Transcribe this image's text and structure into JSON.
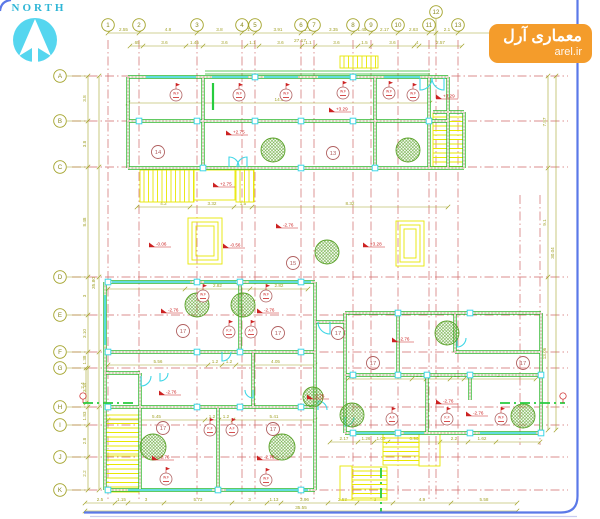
{
  "compass": {
    "label": "NORTH",
    "circle_color": "#55d6ef",
    "arrow_color": "#ffffff"
  },
  "watermark": {
    "line1": "معماری آرل",
    "line2": "arel.ir",
    "bg": "#f49c2b"
  },
  "colors": {
    "wall": "#2eb82e",
    "wall_core": "#ffffff",
    "wall_hatch": "#dd8888",
    "centerline": "#d06868",
    "dim": "#a3a32a",
    "window": "#3fd6e6",
    "stair": "#e8e800",
    "room": "#b06060",
    "balloon": "#b06060",
    "level": "#cc2222",
    "hatch_circle": "#5ba32a",
    "section": "#27cc3e",
    "frame": "#5b79e8",
    "frame_light": "#c9cdf0"
  },
  "grid": {
    "bubble_row_y": 25,
    "bubble_col_x": 60,
    "columns": [
      {
        "l": "1",
        "x": 108
      },
      {
        "l": "2",
        "x": 139
      },
      {
        "l": "3",
        "x": 197
      },
      {
        "l": "4",
        "x": 242
      },
      {
        "l": "5",
        "x": 255
      },
      {
        "l": "6",
        "x": 301
      },
      {
        "l": "7",
        "x": 314
      },
      {
        "l": "8",
        "x": 353
      },
      {
        "l": "9",
        "x": 371
      },
      {
        "l": "10",
        "x": 398
      },
      {
        "l": "11",
        "x": 429
      },
      {
        "l": "12",
        "x": 436,
        "y": 12
      },
      {
        "l": "13",
        "x": 458
      }
    ],
    "rows": [
      {
        "l": "A",
        "y": 76
      },
      {
        "l": "B",
        "y": 121
      },
      {
        "l": "C",
        "y": 167
      },
      {
        "l": "D",
        "y": 277
      },
      {
        "l": "E",
        "y": 315
      },
      {
        "l": "F",
        "y": 352
      },
      {
        "l": "G",
        "y": 368
      },
      {
        "l": "H",
        "y": 407
      },
      {
        "l": "I",
        "y": 425
      },
      {
        "l": "J",
        "y": 457
      },
      {
        "l": "K",
        "y": 490
      }
    ],
    "extra_centerlines_x": [
      {
        "x": 520,
        "y1": 195,
        "y2": 445
      },
      {
        "x": 540,
        "y1": 195,
        "y2": 445
      }
    ]
  },
  "dimlines": [
    {
      "o": "h",
      "pos": 33,
      "ticks": [
        108,
        139,
        197,
        242,
        255,
        301,
        314,
        353,
        371,
        398,
        429,
        436,
        458,
        540
      ],
      "labels": [
        "2.55",
        "4.8",
        "3.8",
        "1",
        "3.91",
        "1.1",
        "3.35",
        "1.45",
        "2.17",
        "2.63",
        ".5",
        "2.1",
        ""
      ]
    },
    {
      "o": "h",
      "pos": 46,
      "ticks": [
        130,
        143,
        186,
        203,
        246,
        259,
        302,
        315,
        358,
        371,
        414,
        419,
        462
      ],
      "labels": [
        ".65",
        "3.6",
        "1.45",
        "3.6",
        "1.1",
        "3.6",
        "1.1",
        "3.6",
        "1.5",
        "3.6",
        ".4",
        "2.57"
      ]
    },
    {
      "o": "v",
      "pos": 88,
      "ticks": [
        76,
        121,
        167,
        277,
        315,
        352,
        368,
        407,
        425,
        457,
        490
      ],
      "labels": [
        "3.8",
        "3.8",
        "8.48",
        "3",
        "3.10",
        "1.38",
        "3.18",
        "1.83",
        "2.8",
        "2.2"
      ]
    },
    {
      "o": "v",
      "pos": 99,
      "ticks": [
        76,
        167,
        277,
        352,
        407,
        490
      ],
      "labels": [
        "",
        "",
        "",
        "",
        ""
      ]
    },
    {
      "o": "v",
      "pos": 548,
      "ticks": [
        76,
        168,
        277,
        430
      ],
      "labels": [
        "7.87",
        "9.1",
        "13.06"
      ]
    },
    {
      "o": "v",
      "pos": 556,
      "ticks": [
        76,
        430
      ],
      "labels": [
        "30.04"
      ]
    },
    {
      "o": "h",
      "pos": 503,
      "ticks": [
        85,
        115,
        128,
        164,
        232,
        267,
        281,
        328,
        357,
        393,
        451,
        517
      ],
      "labels": [
        "2.5",
        "1.15",
        "3",
        "5.73",
        "3",
        "1.13",
        "3.96",
        "2.53",
        "3",
        "4.9",
        "5.58"
      ]
    },
    {
      "o": "h",
      "pos": 511,
      "ticks": [
        85,
        517
      ],
      "labels": [
        "35.55"
      ]
    },
    {
      "o": "h",
      "pos": 103,
      "ticks": [
        128,
        430
      ],
      "labels": [
        "14.5"
      ]
    },
    {
      "o": "h",
      "pos": 207,
      "ticks": [
        137,
        190,
        234,
        252,
        448
      ],
      "labels": [
        "4.2",
        "3.32",
        "1.5",
        "8.32"
      ]
    },
    {
      "o": "h",
      "pos": 289,
      "ticks": [
        108,
        185,
        250,
        308
      ],
      "labels": [
        "",
        "2.82",
        "2.82"
      ]
    },
    {
      "o": "h",
      "pos": 365,
      "ticks": [
        108,
        208,
        222,
        236,
        315
      ],
      "labels": [
        "5.56",
        "1.2",
        "1.2",
        "4.05"
      ]
    },
    {
      "o": "h",
      "pos": 379,
      "ticks": [
        348,
        412,
        426,
        450,
        464,
        536
      ],
      "labels": [
        "5.4",
        "1.2",
        "2",
        "1.2",
        "5.4"
      ]
    },
    {
      "o": "h",
      "pos": 420,
      "ticks": [
        108,
        205,
        219,
        233,
        315
      ],
      "labels": [
        "5.45",
        "1.2",
        "1.2",
        "5.41"
      ]
    },
    {
      "o": "h",
      "pos": 442,
      "ticks": [
        330,
        358,
        374,
        388,
        440,
        468,
        496,
        540
      ],
      "labels": [
        "2.17",
        "1.26",
        "1.06",
        "0.96",
        "2.2",
        "1.62",
        ""
      ]
    },
    {
      "o": "v",
      "pos": 86,
      "ticks": [
        368,
        403
      ],
      "labels": [
        "2.4"
      ]
    }
  ],
  "free_texts": [
    {
      "t": "27.17",
      "x": 300,
      "y": 42
    },
    {
      "t": "35.80",
      "x": 95,
      "y": 283,
      "r": -90
    }
  ],
  "walls": [
    [
      128,
      77,
      448,
      77
    ],
    [
      128,
      121,
      448,
      121
    ],
    [
      128,
      168,
      448,
      168
    ],
    [
      128,
      77,
      128,
      168
    ],
    [
      203,
      77,
      203,
      168
    ],
    [
      375,
      77,
      375,
      168
    ],
    [
      429,
      77,
      429,
      168
    ],
    [
      448,
      77,
      448,
      168
    ],
    [
      433,
      112,
      464,
      112
    ],
    [
      464,
      112,
      464,
      168
    ],
    [
      448,
      168,
      464,
      168
    ],
    [
      105,
      282,
      315,
      282
    ],
    [
      105,
      352,
      315,
      352
    ],
    [
      105,
      407,
      315,
      407
    ],
    [
      105,
      490,
      315,
      490
    ],
    [
      105,
      282,
      105,
      490
    ],
    [
      240,
      282,
      240,
      352
    ],
    [
      315,
      282,
      315,
      490
    ],
    [
      140,
      373,
      140,
      490
    ],
    [
      105,
      373,
      140,
      373
    ],
    [
      218,
      407,
      218,
      490
    ],
    [
      253,
      352,
      253,
      407
    ],
    [
      345,
      313,
      541,
      313
    ],
    [
      345,
      375,
      541,
      375
    ],
    [
      345,
      433,
      541,
      433
    ],
    [
      345,
      313,
      345,
      433
    ],
    [
      541,
      313,
      541,
      433
    ],
    [
      398,
      313,
      398,
      375
    ],
    [
      427,
      375,
      427,
      433
    ],
    [
      455,
      313,
      455,
      352
    ],
    [
      455,
      352,
      541,
      352
    ],
    [
      470,
      375,
      470,
      400
    ],
    [
      315,
      322,
      345,
      322
    ]
  ],
  "canopy": [
    [
      205,
      71,
      430,
      71
    ],
    [
      205,
      74,
      430,
      74
    ]
  ],
  "windows": [
    [
      146,
      77,
      196,
      77
    ],
    [
      212,
      77,
      248,
      77
    ],
    [
      264,
      77,
      298,
      77
    ],
    [
      318,
      77,
      350,
      77
    ],
    [
      384,
      77,
      420,
      77
    ],
    [
      112,
      282,
      190,
      282
    ],
    [
      204,
      282,
      236,
      282
    ],
    [
      249,
      282,
      311,
      282
    ],
    [
      128,
      490,
      212,
      490
    ],
    [
      226,
      490,
      308,
      490
    ],
    [
      350,
      433,
      394,
      433
    ],
    [
      404,
      433,
      424,
      433
    ],
    [
      480,
      433,
      536,
      433
    ],
    [
      105,
      295,
      105,
      345
    ]
  ],
  "squares": [
    [
      139,
      121
    ],
    [
      197,
      121
    ],
    [
      255,
      121
    ],
    [
      301,
      121
    ],
    [
      353,
      121
    ],
    [
      429,
      121
    ],
    [
      255,
      77
    ],
    [
      353,
      77
    ],
    [
      203,
      168
    ],
    [
      301,
      168
    ],
    [
      375,
      168
    ],
    [
      108,
      282
    ],
    [
      197,
      282
    ],
    [
      240,
      282
    ],
    [
      301,
      282
    ],
    [
      108,
      352
    ],
    [
      197,
      352
    ],
    [
      240,
      352
    ],
    [
      301,
      352
    ],
    [
      108,
      407
    ],
    [
      197,
      407
    ],
    [
      240,
      407
    ],
    [
      301,
      407
    ],
    [
      108,
      490
    ],
    [
      218,
      490
    ],
    [
      301,
      490
    ],
    [
      353,
      375
    ],
    [
      398,
      375
    ],
    [
      427,
      375
    ],
    [
      470,
      375
    ],
    [
      541,
      375
    ],
    [
      353,
      433
    ],
    [
      398,
      433
    ],
    [
      470,
      433
    ],
    [
      541,
      433
    ],
    [
      398,
      313
    ],
    [
      470,
      313
    ]
  ],
  "stairs": [
    {
      "x": 140,
      "y": 170,
      "w": 54,
      "h": 32,
      "d": "v"
    },
    {
      "x": 236,
      "y": 170,
      "w": 18,
      "h": 32,
      "d": "v"
    },
    {
      "x": 433,
      "y": 113,
      "w": 31,
      "h": 55,
      "d": "h"
    },
    {
      "x": 340,
      "y": 56,
      "w": 38,
      "h": 12,
      "d": "v"
    },
    {
      "x": 105,
      "y": 415,
      "w": 34,
      "h": 39,
      "d": "h"
    },
    {
      "x": 105,
      "y": 456,
      "w": 34,
      "h": 36,
      "d": "h"
    },
    {
      "x": 383,
      "y": 434,
      "w": 36,
      "h": 31,
      "d": "h"
    },
    {
      "x": 352,
      "y": 467,
      "w": 35,
      "h": 33,
      "d": "h"
    }
  ],
  "stair_outlines": [
    {
      "x": 194,
      "y": 170,
      "w": 41,
      "h": 30
    },
    {
      "x": 419,
      "y": 433,
      "w": 21,
      "h": 33
    },
    {
      "x": 340,
      "y": 466,
      "w": 12,
      "h": 34
    }
  ],
  "ramps": [
    {
      "x": 188,
      "y": 218,
      "w": 34,
      "h": 46
    },
    {
      "x": 396,
      "y": 221,
      "w": 28,
      "h": 45
    }
  ],
  "hatch_circles": [
    [
      273,
      150,
      12
    ],
    [
      408,
      150,
      12
    ],
    [
      327,
      252,
      12
    ],
    [
      197,
      305,
      12
    ],
    [
      243,
      305,
      12
    ],
    [
      447,
      333,
      12
    ],
    [
      352,
      415,
      12
    ],
    [
      523,
      416,
      12
    ],
    [
      153,
      447,
      13
    ],
    [
      282,
      447,
      13
    ],
    [
      313,
      397,
      10
    ]
  ],
  "rooms": [
    {
      "n": "14",
      "x": 158,
      "y": 152
    },
    {
      "n": "13",
      "x": 333,
      "y": 153
    },
    {
      "n": "15",
      "x": 293,
      "y": 263
    },
    {
      "n": "17",
      "x": 183,
      "y": 331
    },
    {
      "n": "17",
      "x": 278,
      "y": 333
    },
    {
      "n": "17",
      "x": 338,
      "y": 333
    },
    {
      "n": "17",
      "x": 373,
      "y": 363
    },
    {
      "n": "17",
      "x": 523,
      "y": 363
    },
    {
      "n": "17",
      "x": 163,
      "y": 428
    },
    {
      "n": "17",
      "x": 273,
      "y": 429
    }
  ],
  "balloons": [
    {
      "t": "W.F",
      "x": 176,
      "y": 95
    },
    {
      "t": "W.F",
      "x": 239,
      "y": 95
    },
    {
      "t": "W.F",
      "x": 286,
      "y": 95
    },
    {
      "t": "W.F",
      "x": 343,
      "y": 93
    },
    {
      "t": "W.F",
      "x": 389,
      "y": 93
    },
    {
      "t": "W.F",
      "x": 413,
      "y": 95
    },
    {
      "t": "W.F",
      "x": 203,
      "y": 296
    },
    {
      "t": "W.F",
      "x": 266,
      "y": 296
    },
    {
      "t": "K.F",
      "x": 229,
      "y": 332
    },
    {
      "t": "A.F",
      "x": 251,
      "y": 332
    },
    {
      "t": "K.F",
      "x": 210,
      "y": 430
    },
    {
      "t": "A.F",
      "x": 232,
      "y": 430
    },
    {
      "t": "W.F",
      "x": 166,
      "y": 479
    },
    {
      "t": "W.F",
      "x": 266,
      "y": 480
    },
    {
      "t": "A.F",
      "x": 392,
      "y": 419
    },
    {
      "t": "K.F",
      "x": 447,
      "y": 419
    },
    {
      "t": "W.F",
      "x": 501,
      "y": 419
    }
  ],
  "levels": [
    {
      "t": "+2.75",
      "x": 235,
      "y": 135
    },
    {
      "t": "+2.75",
      "x": 222,
      "y": 187
    },
    {
      "t": "+3.29",
      "x": 338,
      "y": 112
    },
    {
      "t": "+3.29",
      "x": 445,
      "y": 99
    },
    {
      "t": "+3.28",
      "x": 372,
      "y": 247
    },
    {
      "t": "-0.06",
      "x": 158,
      "y": 247
    },
    {
      "t": "-0.56",
      "x": 232,
      "y": 248
    },
    {
      "t": "-2.76",
      "x": 285,
      "y": 228
    },
    {
      "t": "-2.76",
      "x": 170,
      "y": 313
    },
    {
      "t": "-2.76",
      "x": 266,
      "y": 313
    },
    {
      "t": "-2.76",
      "x": 401,
      "y": 342
    },
    {
      "t": "-2.76",
      "x": 168,
      "y": 395
    },
    {
      "t": "-2.76",
      "x": 316,
      "y": 399
    },
    {
      "t": "-2.76",
      "x": 161,
      "y": 460
    },
    {
      "t": "-2.76",
      "x": 266,
      "y": 460
    },
    {
      "t": "-2.76",
      "x": 445,
      "y": 404
    },
    {
      "t": "-2.76",
      "x": 475,
      "y": 416
    }
  ],
  "doors": [
    {
      "x": 420,
      "y": 78,
      "r": 12,
      "q": 3
    },
    {
      "x": 444,
      "y": 78,
      "r": 12,
      "q": 4
    },
    {
      "x": 229,
      "y": 167,
      "r": 10,
      "q": 1
    },
    {
      "x": 247,
      "y": 167,
      "r": 10,
      "q": 2
    },
    {
      "x": 330,
      "y": 322,
      "r": 12,
      "q": 4
    },
    {
      "x": 457,
      "y": 338,
      "r": 9,
      "q": 3
    },
    {
      "x": 141,
      "y": 376,
      "r": 10,
      "q": 3
    },
    {
      "x": 222,
      "y": 352,
      "r": 9,
      "q": 3
    },
    {
      "x": 318,
      "y": 410,
      "r": 9,
      "q": 1
    },
    {
      "x": 345,
      "y": 417,
      "r": 9,
      "q": 3
    },
    {
      "x": 253,
      "y": 390,
      "r": 8,
      "q": 4
    },
    {
      "x": 160,
      "y": 373,
      "r": 8,
      "q": 3
    }
  ],
  "section_lines": [
    [
      83,
      403,
      137,
      403
    ],
    [
      500,
      403,
      565,
      403
    ],
    [
      381,
      468,
      381,
      512
    ]
  ],
  "section_markers": [
    [
      83,
      396
    ],
    [
      563,
      396
    ]
  ],
  "green_solid": [
    [
      213,
      83,
      213,
      110
    ]
  ]
}
